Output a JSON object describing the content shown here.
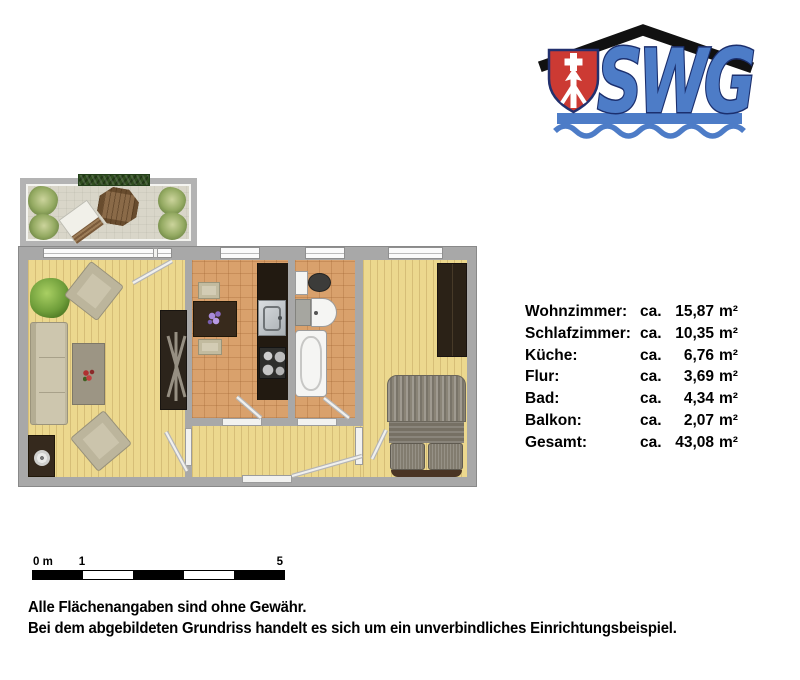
{
  "logo": {
    "letters": "SWG"
  },
  "palette": {
    "logo_blue": "#4d7cc7",
    "logo_navy": "#1b2f6e",
    "shield_red": "#cc3a33",
    "roof_black": "#111111",
    "wall_gray": "#a8a8a8",
    "wood_floor": "#ecd88e",
    "tile_floor": "#d9a16c",
    "balcony_stone": "#d9d6c9"
  },
  "areas": {
    "rows": [
      {
        "name": "Wohnzimmer:",
        "ca": "ca.",
        "value": "15,87",
        "unit": "m²"
      },
      {
        "name": "Schlafzimmer:",
        "ca": "ca.",
        "value": "10,35",
        "unit": "m²"
      },
      {
        "name": "Küche:",
        "ca": "ca.",
        "value": "6,76",
        "unit": "m²"
      },
      {
        "name": "Flur:",
        "ca": "ca.",
        "value": "3,69",
        "unit": "m²"
      },
      {
        "name": "Bad:",
        "ca": "ca.",
        "value": "4,34",
        "unit": "m²"
      },
      {
        "name": "Balkon:",
        "ca": "ca.",
        "value": "2,07",
        "unit": "m²"
      },
      {
        "name": "Gesamt:",
        "ca": "ca.",
        "value": "43,08",
        "unit": "m²"
      }
    ]
  },
  "scalebar": {
    "label_zero": "0 m",
    "label_one": "1",
    "label_five": "5"
  },
  "disclaimer": {
    "line1": "Alle Flächenangaben sind ohne Gewähr.",
    "line2": "Bei dem abgebildeten Grundriss handelt es sich um ein unverbindliches Einrichtungsbeispiel."
  }
}
